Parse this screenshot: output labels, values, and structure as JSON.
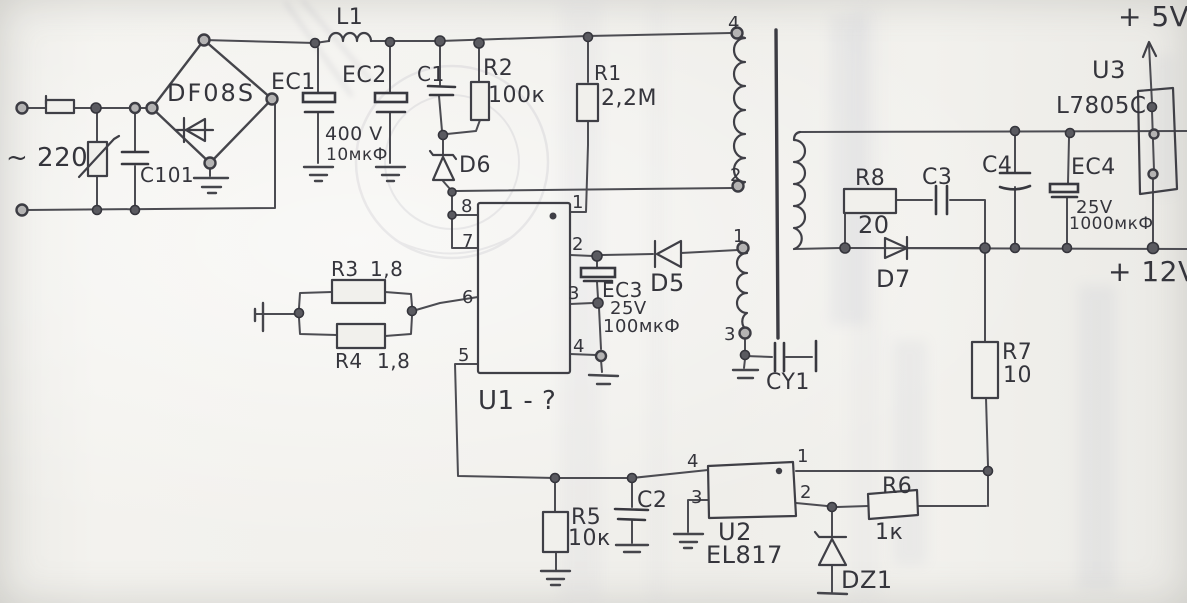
{
  "title": "Hand-drawn switching power supply schematic",
  "colors": {
    "ink": "#45454b",
    "paper": "#f1f0ec"
  },
  "labels": {
    "ac_input": "~ 220",
    "c101": "C101",
    "bridge": "DF08S",
    "ec1": "EC1",
    "ec2": "EC2",
    "bulk_voltage": "400 V",
    "bulk_capacitance": "10мкФ",
    "l1": "L1",
    "c1": "C1",
    "r2": "R2",
    "r2_value": "100к",
    "r1": "R1",
    "r1_value": "2,2M",
    "d6": "D6",
    "u1": "U1 - ?",
    "u1_pin8": "8",
    "u1_pin7": "7",
    "u1_pin6": "6",
    "u1_pin5": "5",
    "u1_pin1": "1",
    "u1_pin2": "2",
    "u1_pin3": "3",
    "u1_pin4": "4",
    "r3": "R3",
    "r3_value": "1,8",
    "r4": "R4",
    "r4_value": "1,8",
    "ec3": "EC3",
    "ec3_voltage": "25V",
    "ec3_capacitance": "100мкФ",
    "d5": "D5",
    "xfmr_pin4": "4",
    "xfmr_pin2": "2",
    "xfmr_pin1": "1",
    "xfmr_pin3": "3",
    "cy1": "CY1",
    "r8": "R8",
    "r8_value": "20",
    "c3": "C3",
    "d7": "D7",
    "c4": "C4",
    "ec4": "EC4",
    "ec4_voltage": "25V",
    "ec4_capacitance": "1000мкФ",
    "u3": "U3",
    "u3_part": "L7805C",
    "rail_5v": "+ 5V",
    "rail_12v": "+ 12V",
    "r7": "R7",
    "r7_value": "10",
    "r5": "R5",
    "r5_value": "10к",
    "c2": "C2",
    "u2": "U2",
    "u2_part": "EL817",
    "u2_pin4": "4",
    "u2_pin3": "3",
    "u2_pin1": "1",
    "u2_pin2": "2",
    "r6": "R6",
    "r6_value": "1к",
    "dz1": "DZ1"
  }
}
